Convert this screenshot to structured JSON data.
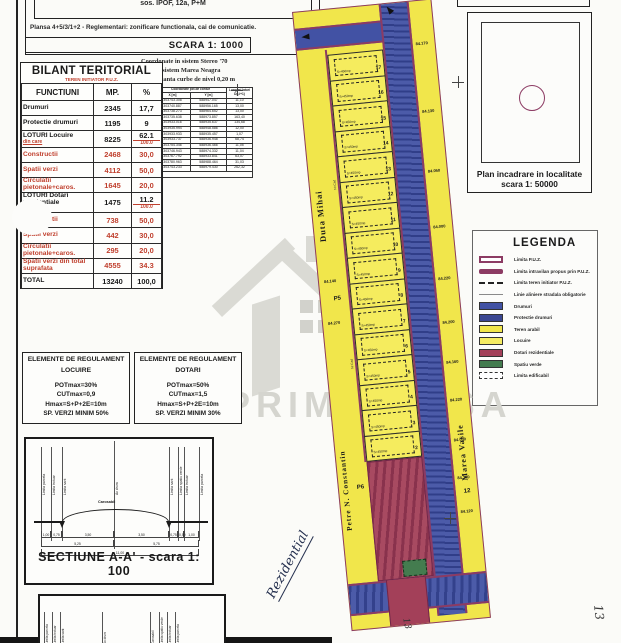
{
  "title_block": {
    "top_text": "sos. IPOF, 12a, P+M",
    "plansa": "Plansa 4+5/3/1+2 - Reglementari: zonificare functionala, cai de comunicatie.",
    "scale": "SCARA 1: 1000"
  },
  "bilant": {
    "title": "BILANT TERITORIAL",
    "subtitle": "TEREN INITIATOR P.U.Z.",
    "headers": [
      "FUNCTIUNI",
      "MP.",
      "%"
    ],
    "rows": [
      {
        "label": "Drumuri",
        "mp": "2345",
        "pct": "17,7",
        "style": "black"
      },
      {
        "label": "Protectie drumuri",
        "mp": "1195",
        "pct": "9",
        "style": "black"
      },
      {
        "label": "LOTURI Locuire",
        "sub": "din care",
        "mp": "8225",
        "pct": "62.1",
        "pct2": "100.0",
        "style": "mixed"
      },
      {
        "label": "Constructii",
        "mp": "2468",
        "pct": "30,0",
        "style": "red"
      },
      {
        "label": "Spatii verzi",
        "mp": "4112",
        "pct": "50,0",
        "style": "red"
      },
      {
        "label": "Circulatii pietonale+caros.",
        "mp": "1645",
        "pct": "20,0",
        "style": "red"
      },
      {
        "label": "LOTURI Dotari rezidentiale",
        "sub": "din care",
        "mp": "1475",
        "pct": "11.2",
        "pct2": "100.0",
        "style": "mixed"
      },
      {
        "label": "Constructii",
        "mp": "738",
        "pct": "50,0",
        "style": "red"
      },
      {
        "label": "Spatii verzi",
        "mp": "442",
        "pct": "30,0",
        "style": "red"
      },
      {
        "label": "Circulatii pietonale+caros.",
        "mp": "295",
        "pct": "20,0",
        "style": "red"
      },
      {
        "label": "Spatii verzi din total suprafata",
        "mp": "4555",
        "pct": "34.3",
        "style": "red"
      },
      {
        "label": "TOTAL",
        "mp": "13240",
        "pct": "100,0",
        "style": "total"
      }
    ]
  },
  "coords": {
    "note_lines": [
      "Coordonate in sistem Stereo '70",
      "Cote in sistem Marea Neagra",
      "Echidistanta curbe de nivel  0,20 m"
    ],
    "col_nr": "Nr. Pct.",
    "col_group": "Coordonate pct.de contur",
    "col_x": "X [m]",
    "col_y": "Y [m]",
    "col_d": "Lungimi laturi D(i,i+1)",
    "rows": [
      [
        "P1",
        "303743.308",
        "588947.047",
        "11,10"
      ],
      [
        "P2",
        "303740.887",
        "588956.165",
        "13,00"
      ],
      [
        "P3",
        "303738.273",
        "588964.652",
        "13,00"
      ],
      [
        "P4",
        "303735.638",
        "588973.857",
        "163,40"
      ],
      [
        "P5",
        "303933.016",
        "588935.637",
        "134,68"
      ],
      [
        "P6",
        "303935.994",
        "588948.586",
        "12,00"
      ],
      [
        "P7",
        "303933.933",
        "588935.457",
        "1,07"
      ],
      [
        "P8",
        "303933.737",
        "588936.948",
        "68,74"
      ],
      [
        "P9",
        "303754.346",
        "588936.466",
        "11,05"
      ],
      [
        "P10",
        "303746.943",
        "588974.332",
        "11,04"
      ],
      [
        "P11",
        "303767.792",
        "588933.841",
        "63,07"
      ],
      [
        "P12",
        "303780.963",
        "588988.464",
        "31,03"
      ],
      [
        "P13",
        "303743.233",
        "588979.430",
        "262,32"
      ]
    ],
    "footer": "S = 13240"
  },
  "incadrare": {
    "line1": "Plan incadrare in localitate",
    "line2": "scara 1: 50000"
  },
  "legend": {
    "title": "LEGENDA",
    "items": [
      {
        "swatch": "puz-outline",
        "label": "Limita P.U.Z."
      },
      {
        "swatch": "purple-bar",
        "label": "Limita intravilan propus prin P.U.Z."
      },
      {
        "swatch": "dashed-line",
        "label": "Limita teren initiator P.U.Z."
      },
      {
        "swatch": "gray-line",
        "label": "Linie aliniere stradala obligatorie"
      },
      {
        "swatch": "blue",
        "label": "Drumuri"
      },
      {
        "swatch": "dark-blue",
        "label": "Protectie drumuri"
      },
      {
        "swatch": "yellow",
        "label": "Teren arabil"
      },
      {
        "swatch": "yellow2",
        "label": "Locuire"
      },
      {
        "swatch": "maroon",
        "label": "Dotari rezidentiale"
      },
      {
        "swatch": "green",
        "label": "Spatiu verde"
      },
      {
        "swatch": "dashed-box",
        "label": "Limita edificabil"
      }
    ]
  },
  "regulament": {
    "locuire": {
      "title1": "ELEMENTE DE REGULAMENT",
      "title2": "LOCUIRE",
      "lines": [
        "POTmax=30%",
        "CUTmax=0,9",
        "Hmax=S+P+2E=10m",
        "SP. VERZI MINIM 50%"
      ]
    },
    "dotari": {
      "title1": "ELEMENTE DE REGULAMENT",
      "title2": "DOTARI",
      "lines": [
        "POTmax=50%",
        "CUTmax=1,5",
        "Hmax=S+P+2E=10m",
        "SP. VERZI MINIM 30%"
      ]
    }
  },
  "section": {
    "caption": "SECTIUNE A-A' - scara 1: 100",
    "labels": [
      "Limita parcela",
      "Limita trotuar",
      "Limita sant",
      "Ax drum",
      "Limita sant",
      "Limita spatiu verde",
      "Limita trotuar",
      "Limita parcela"
    ],
    "road_label": "Carosabil",
    "dims": [
      "1,00",
      "0,75",
      "3,50",
      "3,50",
      "0,75",
      "0,50",
      "1,00"
    ],
    "dims2": [
      "5,25",
      "5,75"
    ],
    "total": "11,00"
  },
  "section2": {
    "labels": [
      "Limita parcela",
      "Limita trotuar",
      "Limita sant",
      "Ax drum",
      "Carosabil",
      "Limita spatiu verde",
      "Limita trotuar",
      "Limita parcela"
    ]
  },
  "plan": {
    "street_left_top": "Duta Mihai",
    "street_left_bottom": "Petre N. Constantin",
    "street_right": "Marea Vasile",
    "lot_numbers": [
      17,
      16,
      15,
      14,
      13,
      12,
      11,
      10,
      9,
      8,
      7,
      6,
      5,
      4,
      3,
      2
    ],
    "lot_area_label": "S=450mp",
    "elevations_right": [
      "84.170",
      "84.130",
      "84.050",
      "84.000",
      "84.220",
      "84.200",
      "84.160",
      "84.220",
      "84.050",
      "84.100",
      "84.120"
    ],
    "elevations_left": [
      "84.140",
      "84.270"
    ],
    "point_markers": [
      "P5",
      "P6"
    ],
    "cad_label": "Nr.Cad",
    "corner_note": "12",
    "handwriting_note": "Rezidential",
    "handwriting_number": "13"
  },
  "watermark": {
    "text": "PRIMA CASA"
  },
  "colors": {
    "puz_line": "#8c3b63",
    "road": "#4252a4",
    "road_protect": "#3a4691",
    "locuire": "#f1e64b",
    "dotari": "#a34059",
    "verde": "#447c4f",
    "table_red": "#c0402e"
  }
}
